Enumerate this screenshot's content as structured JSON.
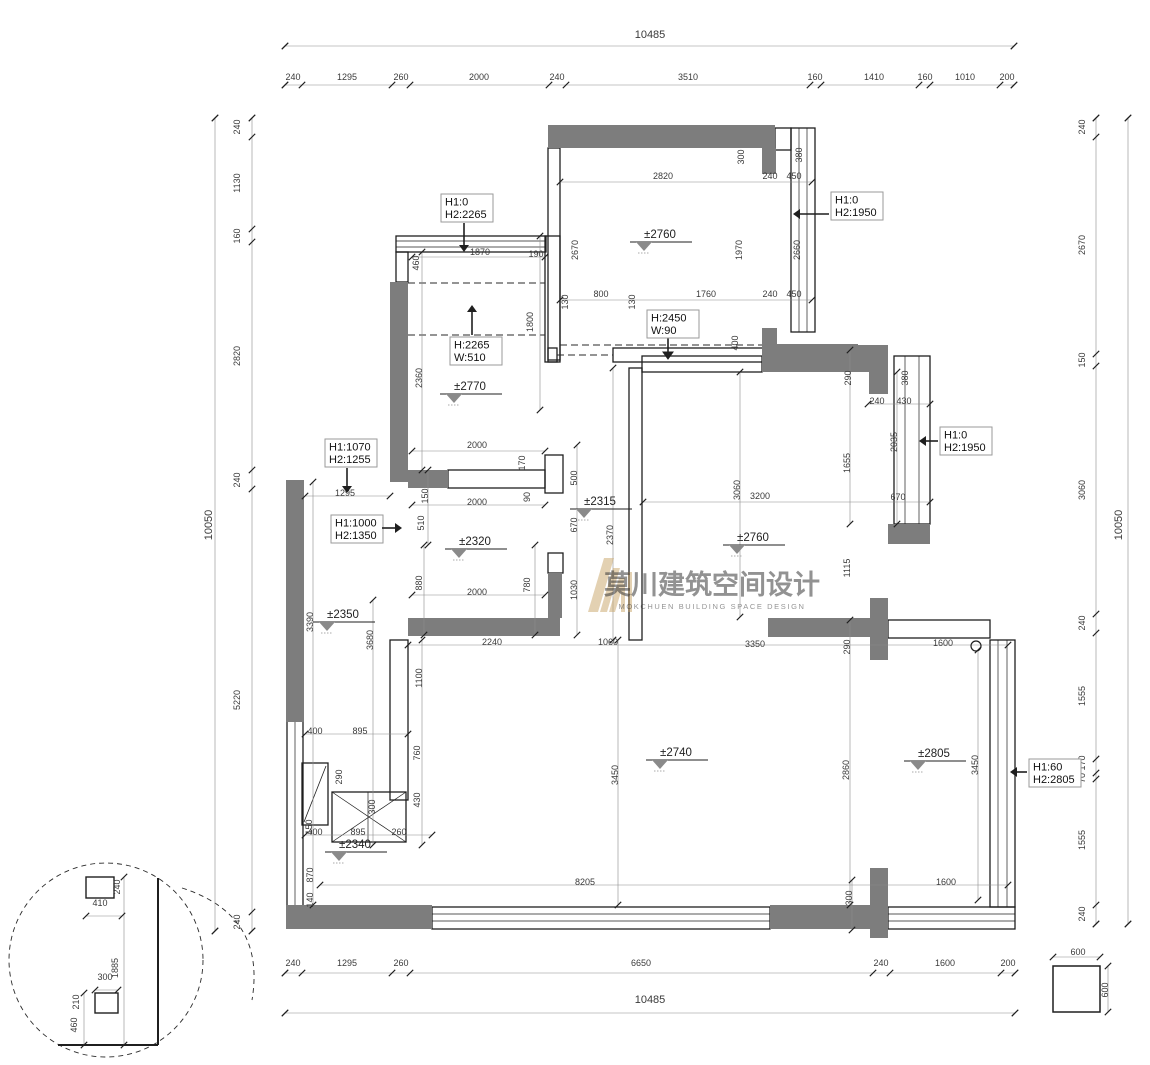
{
  "drawing": {
    "watermark_cn": "莫川建筑空间设计",
    "watermark_en": "MOKCHUEN BUILDING SPACE DESIGN"
  },
  "colors": {
    "wall_fill": "#7d7d7d",
    "line": "#1f1f1f",
    "dim_text": "#3a3a3a",
    "watermark": "#c8a468",
    "level_triangle": "#8a8a8a"
  },
  "chains": {
    "top": {
      "total": "10485",
      "segments": [
        "240",
        "1295",
        "260",
        "2000",
        "240",
        "3510",
        "160",
        "1410",
        "160",
        "1010",
        "200"
      ]
    },
    "bottom": {
      "total": "10485",
      "segments": [
        "240",
        "1295",
        "260",
        "6650",
        "240",
        "1600",
        "200"
      ]
    },
    "left": {
      "total": "10050",
      "segments": [
        "240",
        "1130",
        "160",
        "2820",
        "240",
        "5220",
        "240"
      ]
    },
    "right": {
      "total": "10050",
      "segments": [
        "240",
        "2670",
        "150",
        "3060",
        "240",
        "1555",
        "170",
        "70",
        "1555",
        "240"
      ]
    }
  },
  "total_labels": [
    [
      "10485",
      650,
      38
    ],
    [
      "10485",
      650,
      1003
    ],
    [
      "10050",
      212,
      525,
      "v"
    ],
    [
      "10050",
      1122,
      525,
      "v"
    ]
  ],
  "dim_labels": [
    [
      "240",
      293,
      80
    ],
    [
      "1295",
      347,
      80
    ],
    [
      "260",
      401,
      80
    ],
    [
      "2000",
      479,
      80
    ],
    [
      "240",
      557,
      80
    ],
    [
      "3510",
      688,
      80
    ],
    [
      "160",
      815,
      80
    ],
    [
      "1410",
      874,
      80
    ],
    [
      "160",
      925,
      80
    ],
    [
      "1010",
      965,
      80
    ],
    [
      "200",
      1007,
      80
    ],
    [
      "240",
      293,
      966
    ],
    [
      "1295",
      347,
      966
    ],
    [
      "260",
      401,
      966
    ],
    [
      "6650",
      641,
      966
    ],
    [
      "240",
      881,
      966
    ],
    [
      "1600",
      945,
      966
    ],
    [
      "200",
      1008,
      966
    ],
    [
      "240",
      240,
      127,
      "v"
    ],
    [
      "1130",
      240,
      183,
      "v"
    ],
    [
      "160",
      240,
      236,
      "v"
    ],
    [
      "2820",
      240,
      356,
      "v"
    ],
    [
      "240",
      240,
      480,
      "v"
    ],
    [
      "5220",
      240,
      700,
      "v"
    ],
    [
      "240",
      240,
      922,
      "v"
    ],
    [
      "240",
      1085,
      127,
      "v"
    ],
    [
      "2670",
      1085,
      245,
      "v"
    ],
    [
      "150",
      1085,
      360,
      "v"
    ],
    [
      "3060",
      1085,
      490,
      "v"
    ],
    [
      "240",
      1085,
      623,
      "v"
    ],
    [
      "1555",
      1085,
      696,
      "v"
    ],
    [
      "170",
      1085,
      763,
      "v"
    ],
    [
      "70",
      1085,
      778,
      "v"
    ],
    [
      "1555",
      1085,
      840,
      "v"
    ],
    [
      "240",
      1085,
      914,
      "v"
    ],
    [
      "2820",
      663,
      179
    ],
    [
      "240",
      770,
      179
    ],
    [
      "450",
      794,
      179
    ],
    [
      "300",
      744,
      157,
      "v"
    ],
    [
      "380",
      802,
      155,
      "v"
    ],
    [
      "2670",
      578,
      250,
      "v"
    ],
    [
      "1970",
      742,
      250,
      "v"
    ],
    [
      "2660",
      800,
      250,
      "v"
    ],
    [
      "130",
      568,
      302,
      "v"
    ],
    [
      "800",
      601,
      297
    ],
    [
      "130",
      635,
      302,
      "v"
    ],
    [
      "1760",
      706,
      297
    ],
    [
      "240",
      770,
      297
    ],
    [
      "450",
      794,
      297
    ],
    [
      "460",
      419,
      263,
      "v"
    ],
    [
      "1870",
      480,
      255
    ],
    [
      "190",
      536,
      257
    ],
    [
      "1800",
      533,
      322,
      "v"
    ],
    [
      "2360",
      422,
      378,
      "v"
    ],
    [
      "2000",
      477,
      448
    ],
    [
      "170",
      525,
      463,
      "v"
    ],
    [
      "90",
      530,
      497,
      "v"
    ],
    [
      "150",
      428,
      496,
      "v"
    ],
    [
      "510",
      424,
      523,
      "v"
    ],
    [
      "1295",
      345,
      496
    ],
    [
      "2000",
      477,
      505
    ],
    [
      "880",
      422,
      583,
      "v"
    ],
    [
      "780",
      530,
      585,
      "v"
    ],
    [
      "2000",
      477,
      595
    ],
    [
      "500",
      577,
      478,
      "v"
    ],
    [
      "670",
      577,
      525,
      "v"
    ],
    [
      "1030",
      577,
      590,
      "v"
    ],
    [
      "2370",
      613,
      535,
      "v"
    ],
    [
      "400",
      738,
      343,
      "v"
    ],
    [
      "3060",
      740,
      490,
      "v"
    ],
    [
      "3200",
      760,
      499
    ],
    [
      "290",
      851,
      378,
      "v"
    ],
    [
      "240",
      877,
      404
    ],
    [
      "430",
      904,
      404
    ],
    [
      "380",
      908,
      378,
      "v"
    ],
    [
      "2035",
      897,
      442,
      "v"
    ],
    [
      "1655",
      850,
      463,
      "v"
    ],
    [
      "670",
      898,
      500
    ],
    [
      "1115",
      850,
      568,
      "v"
    ],
    [
      "3350",
      755,
      647
    ],
    [
      "290",
      850,
      647,
      "v"
    ],
    [
      "2240",
      492,
      645
    ],
    [
      "1060",
      608,
      645
    ],
    [
      "1600",
      943,
      646
    ],
    [
      "3450",
      618,
      775,
      "v"
    ],
    [
      "2860",
      849,
      770,
      "v"
    ],
    [
      "3450",
      978,
      765,
      "v"
    ],
    [
      "8205",
      585,
      885
    ],
    [
      "300",
      852,
      898,
      "v"
    ],
    [
      "1600",
      946,
      885
    ],
    [
      "140",
      313,
      900,
      "v"
    ],
    [
      "870",
      313,
      875,
      "v"
    ],
    [
      "3390",
      313,
      622,
      "v"
    ],
    [
      "3680",
      373,
      640,
      "v"
    ],
    [
      "1100",
      422,
      678,
      "v"
    ],
    [
      "400",
      315,
      734
    ],
    [
      "895",
      360,
      734
    ],
    [
      "290",
      342,
      777,
      "v"
    ],
    [
      "760",
      420,
      753,
      "v"
    ],
    [
      "430",
      420,
      800,
      "v"
    ],
    [
      "300",
      375,
      807,
      "v"
    ],
    [
      "150",
      312,
      827,
      "v"
    ],
    [
      "400",
      315,
      835
    ],
    [
      "895",
      358,
      835
    ],
    [
      "260",
      399,
      835
    ],
    [
      "240",
      120,
      887,
      "v"
    ],
    [
      "410",
      100,
      906
    ],
    [
      "1885",
      118,
      968,
      "v"
    ],
    [
      "300",
      105,
      980
    ],
    [
      "210",
      79,
      1002,
      "v"
    ],
    [
      "460",
      77,
      1025,
      "v"
    ],
    [
      "600",
      1078,
      955
    ],
    [
      "600",
      1108,
      990,
      "v"
    ]
  ],
  "levels": [
    [
      "±2760",
      660,
      238
    ],
    [
      "±2770",
      470,
      390
    ],
    [
      "±2315",
      600,
      505
    ],
    [
      "±2320",
      475,
      545
    ],
    [
      "±2760",
      753,
      541
    ],
    [
      "±2350",
      343,
      618
    ],
    [
      "±2740",
      676,
      756
    ],
    [
      "±2805",
      934,
      757
    ],
    [
      "±2340",
      355,
      848
    ]
  ],
  "callouts": [
    {
      "lines": [
        "H1:0",
        "H2:2265"
      ],
      "x": 441,
      "y": 194,
      "arrow": [
        464,
        223,
        464,
        245
      ],
      "dir": "down"
    },
    {
      "lines": [
        "H1:0",
        "H2:1950"
      ],
      "x": 831,
      "y": 192,
      "arrow": [
        829,
        214,
        800,
        214
      ],
      "dir": "left"
    },
    {
      "lines": [
        "H:2265",
        "W:510"
      ],
      "x": 450,
      "y": 337,
      "arrow": [
        472,
        335,
        472,
        312
      ],
      "dir": "up"
    },
    {
      "lines": [
        "H:2450",
        "W:90"
      ],
      "x": 647,
      "y": 310,
      "arrow": null,
      "dir": null
    },
    {
      "lines": [
        "H1:1070",
        "H2:1255"
      ],
      "x": 325,
      "y": 439,
      "arrow": [
        347,
        468,
        347,
        486
      ],
      "dir": "down"
    },
    {
      "lines": [
        "H1:1000",
        "H2:1350"
      ],
      "x": 331,
      "y": 515,
      "arrow": [
        382,
        528,
        395,
        528
      ],
      "dir": "right"
    },
    {
      "lines": [
        "H1:0",
        "H2:1950"
      ],
      "x": 940,
      "y": 427,
      "arrow": [
        938,
        441,
        926,
        441
      ],
      "dir": "left"
    },
    {
      "lines": [
        "H1:60",
        "H2:2805"
      ],
      "x": 1029,
      "y": 759,
      "arrow": [
        1027,
        772,
        1017,
        772
      ],
      "dir": "left"
    }
  ],
  "symbols": {
    "wall_circle": {
      "x": 976,
      "y": 646,
      "r": 5
    },
    "corridor_down_arrow": {
      "x": 668,
      "y1": 336,
      "y2": 352
    }
  }
}
